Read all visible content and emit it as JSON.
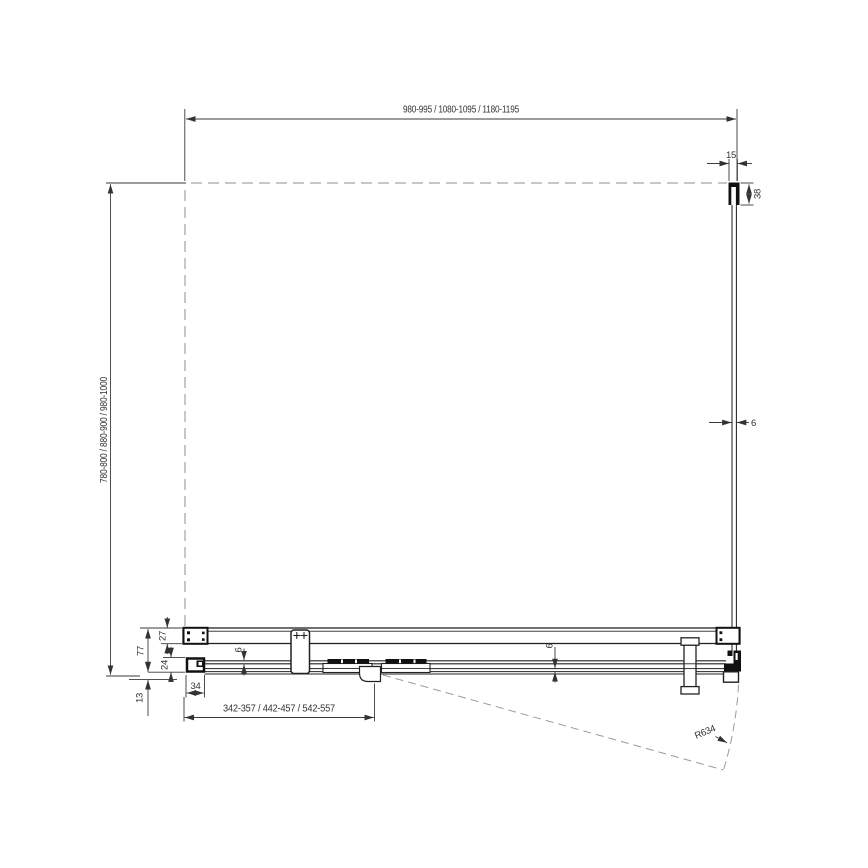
{
  "colors": {
    "outline": "#222222",
    "dimension": "#3a3a3a",
    "dashed": "#8f8f8f"
  },
  "dims": {
    "top_width": "980-995 / 1080-1095 / 1180-1195",
    "left_depth": "780-800 / 880-900 / 980-1000",
    "wall_profile_width": "15",
    "wall_profile_depth": "38",
    "side_glass_thickness": "6",
    "assembly_depth": "77",
    "rail_depth": "27",
    "profile_depth": "24",
    "threshold": "13",
    "profile_width": "34",
    "door_glass_thickness_left": "6",
    "door_glass_thickness_right": "6",
    "entry_width": "342-357 / 442-457 / 542-557",
    "swing_radius": "R634"
  }
}
